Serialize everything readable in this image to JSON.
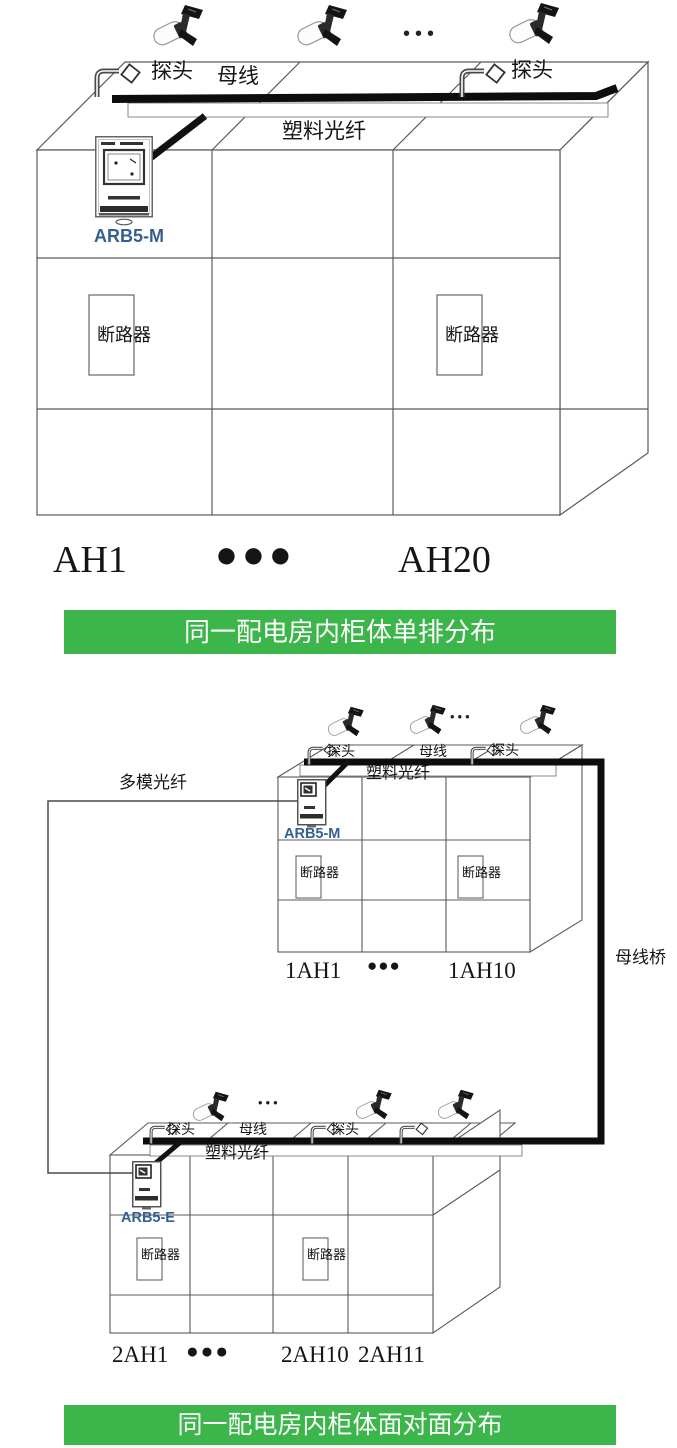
{
  "colors": {
    "banner_green": "#3cb54b",
    "device_label_blue": "#365f91",
    "line_dark": "#111111"
  },
  "diagram1": {
    "probe_label_left": "探头",
    "busbar_label": "母线",
    "probe_label_right": "探头",
    "plastic_fiber_label": "塑料光纤",
    "device_label": "ARB5-M",
    "breaker_label_left": "断路器",
    "breaker_label_right": "断路器",
    "sensor_ellipsis": "•••",
    "cabinet_first": "AH1",
    "cabinet_ellipsis": "●●●",
    "cabinet_last": "AH20",
    "banner": "同一配电房内柜体单排分布"
  },
  "diagram2": {
    "multimode_fiber_label": "多模光纤",
    "probe_label_left": "探头",
    "busbar_label": "母线",
    "probe_label_right": "探头",
    "plastic_fiber_label": "塑料光纤",
    "device_label": "ARB5-M",
    "breaker_label_left": "断路器",
    "breaker_label_right": "断路器",
    "sensor_ellipsis": "•••",
    "cabinet_first": "1AH1",
    "cabinet_ellipsis": "●●●",
    "cabinet_last": "1AH10",
    "busbar_bridge_label": "母线桥"
  },
  "diagram3": {
    "probe_label_left": "探头",
    "busbar_label": "母线",
    "probe_label_right": "探头",
    "plastic_fiber_label": "塑料光纤",
    "device_label": "ARB5-E",
    "breaker_label_left": "断路器",
    "breaker_label_right": "断路器",
    "sensor_ellipsis": "•••",
    "cabinet_first": "2AH1",
    "cabinet_ellipsis": "●●●",
    "cabinet_mid": "2AH10",
    "cabinet_last": "2AH11",
    "banner": "同一配电房内柜体面对面分布"
  }
}
